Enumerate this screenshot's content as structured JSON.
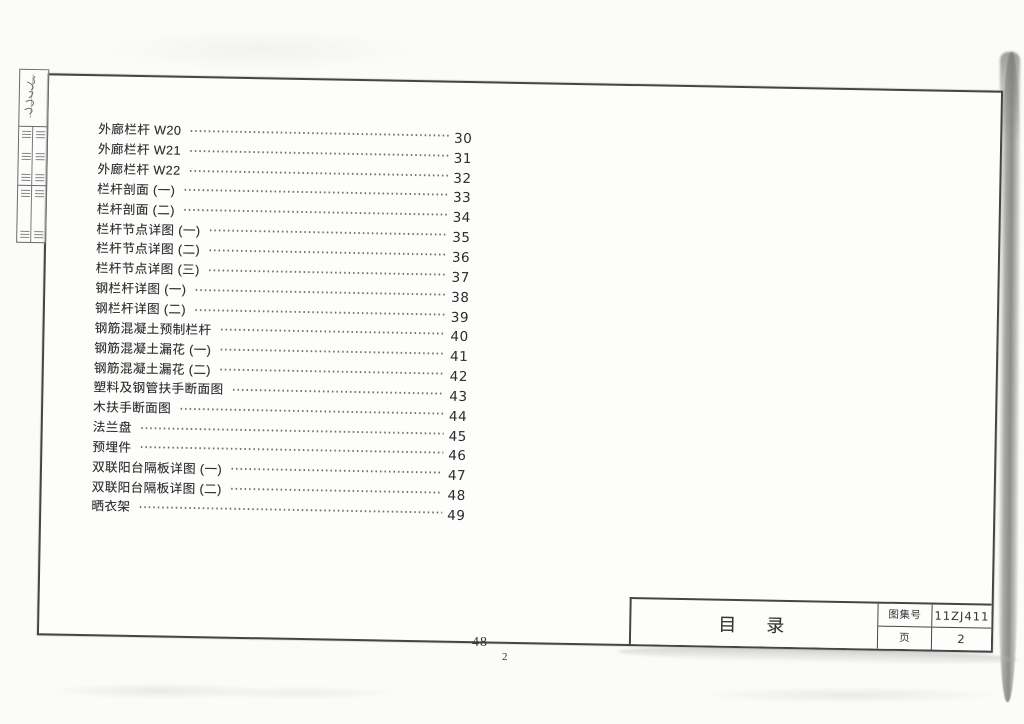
{
  "sheet": {
    "title": "目　录",
    "title_block": {
      "atlas_label": "图集号",
      "atlas_value": "11ZJ411",
      "page_label": "页",
      "page_value": "2"
    },
    "footer": {
      "book_page": "48",
      "print_page": "2"
    }
  },
  "toc": {
    "entries": [
      {
        "label": "外廊栏杆 W20",
        "page": "30"
      },
      {
        "label": "外廊栏杆 W21",
        "page": "31"
      },
      {
        "label": "外廊栏杆 W22",
        "page": "32"
      },
      {
        "label": "栏杆剖面 (一)",
        "page": "33"
      },
      {
        "label": "栏杆剖面 (二)",
        "page": "34"
      },
      {
        "label": "栏杆节点详图 (一)",
        "page": "35"
      },
      {
        "label": "栏杆节点详图 (二)",
        "page": "36"
      },
      {
        "label": "栏杆节点详图 (三)",
        "page": "37"
      },
      {
        "label": "钢栏杆详图 (一)",
        "page": "38"
      },
      {
        "label": "钢栏杆详图 (二)",
        "page": "39"
      },
      {
        "label": "钢筋混凝土预制栏杆",
        "page": "40"
      },
      {
        "label": "钢筋混凝土漏花 (一)",
        "page": "41"
      },
      {
        "label": "钢筋混凝土漏花 (二)",
        "page": "42"
      },
      {
        "label": "塑料及钢管扶手断面图",
        "page": "43"
      },
      {
        "label": "木扶手断面图",
        "page": "44"
      },
      {
        "label": "法兰盘",
        "page": "45"
      },
      {
        "label": "预埋件",
        "page": "46"
      },
      {
        "label": "双联阳台隔板详图 (一)",
        "page": "47"
      },
      {
        "label": "双联阳台隔板详图 (二)",
        "page": "48"
      },
      {
        "label": "晒衣架",
        "page": "49"
      }
    ]
  }
}
